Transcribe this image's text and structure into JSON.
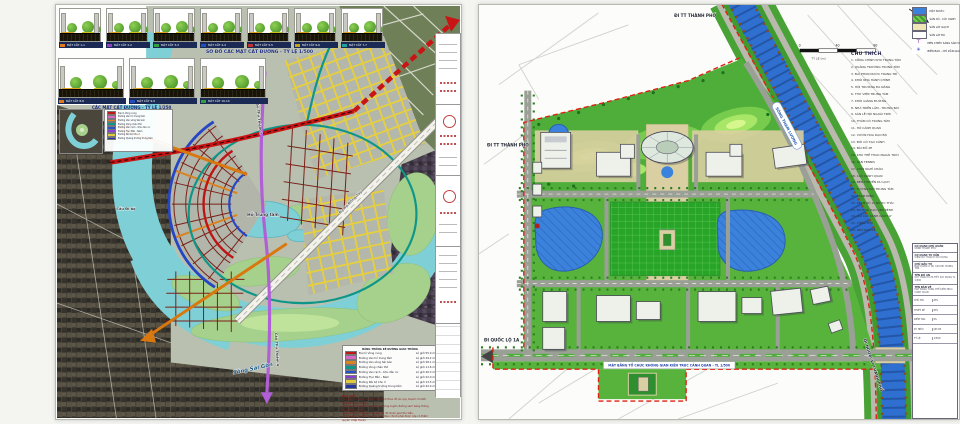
{
  "left_sheet": {
    "titles": {
      "row1_title": "SƠ ĐỒ CÁC MẶT CẮT ĐƯỜNG - TỶ LỆ 1/500",
      "row2_title": "CÁC MẶT CẮT ĐƯỜNG - TỶ LỆ 1/250"
    },
    "cross_sections_row1": [
      {
        "caption": "MẶT CẮT 1-1",
        "chip": "#e07820"
      },
      {
        "caption": "MẶT CẮT 2-2",
        "chip": "#9040c0"
      },
      {
        "caption": "MẶT CẮT 3-3",
        "chip": "#30a040"
      },
      {
        "caption": "MẶT CẮT 4-4",
        "chip": "#2050c0"
      },
      {
        "caption": "MẶT CẮT 5-5",
        "chip": "#c03030"
      },
      {
        "caption": "MẶT CẮT 6-6",
        "chip": "#c0a020"
      },
      {
        "caption": "MẶT CẮT 7-7",
        "chip": "#20a0a0"
      }
    ],
    "cross_sections_row2": [
      {
        "caption": "MẶT CẮT 8-8",
        "chip": "#e07820"
      },
      {
        "caption": "MẶT CẮT 9-9",
        "chip": "#2050c0"
      },
      {
        "caption": "MẶT CẮT 10-10",
        "chip": "#30a040"
      }
    ],
    "map_labels": {
      "river": "Sông Sài Gòn",
      "lake": "Hồ Trung tâm",
      "bridge_2": "Cầu Thủ Thiêm 2",
      "bridge_4": "Cầu Thủ Thiêm 4",
      "ped_bridge": "Cầu Đi bộ",
      "avenue": "Đại lộ Đông Tây"
    },
    "legend": {
      "header": "BẢNG THỐNG KÊ ĐƯỜNG GIAO THÔNG",
      "rows": [
        {
          "color": "#c01818",
          "label": "Đại lộ Vòng cung",
          "value": "Lộ giới 55.0 m"
        },
        {
          "color": "#d967c8",
          "label": "Đường Ven hồ trung tâm",
          "value": "Lộ giới 29.2 m"
        },
        {
          "color": "#d98422",
          "label": "Đường Ven sông Sài Gòn",
          "value": "Lộ giới 28.1 m"
        },
        {
          "color": "#0e9688",
          "label": "Đường Vùng châu thổ",
          "value": "Lộ giới 11.6 m"
        },
        {
          "color": "#2a52c8",
          "label": "Đường Ven rạch - Khu dân cư",
          "value": "Lộ giới 26.3 m"
        },
        {
          "color": "#8a3fd0",
          "label": "Đường Trục Bắc - Nam",
          "value": "Lộ giới 22.0 m"
        },
        {
          "color": "#e3c93e",
          "label": "Đường Nội bộ khu ở",
          "value": "Lộ giới 13.3 m"
        },
        {
          "color": "#27379e",
          "label": "Đường Quảng trường trung tâm",
          "value": "Lộ giới 42.0 m"
        }
      ]
    },
    "note": {
      "heading": "Ghi chú:",
      "lines": [
        "- Lộ giới các tuyến đường xác định theo đồ án quy hoạch chi tiết 1/2000 được duyệt.",
        "- Thông số kỹ thuật chi tiết của từng tuyến đường xem bảng thống kê mặt cắt đường.",
        "- Cao độ thiết kế lấy theo hệ cao độ Quốc gia Hòn Dấu.",
        "- Trong quá trình triển khai, mọi điều chỉnh phải được cấp có thẩm quyền chấp thuận."
      ]
    }
  },
  "right_sheet": {
    "scale_bar": {
      "ticks": [
        "0",
        "40",
        "80"
      ],
      "label": "TỶ LỆ (m)"
    },
    "legend": {
      "items": [
        {
          "icon": "water-swatch",
          "label": "MẶT NƯỚC"
        },
        {
          "icon": "green-swatch",
          "label": "SÂN CỎ - CÂY XANH"
        },
        {
          "icon": "brick-swatch",
          "label": "SÂN LÁT GẠCH"
        },
        {
          "icon": "stone-swatch",
          "label": "SÂN LÁT ĐÁ"
        },
        {
          "icon": "lamp-icon",
          "label": "ĐÈN CHIẾU SÁNG SÂN VƯỜN"
        },
        {
          "icon": "sign-icon",
          "label": "BIỂN BÁO - CHỈ DẪN GIAO THÔNG"
        }
      ]
    },
    "notes": {
      "heading": "CHÚ THÍCH",
      "items": [
        "1. CỔNG CHÍNH KHU TRUNG TÂM",
        "2. QUẢNG TRƯỜNG TRUNG TÂM",
        "3. ĐÀI PHUN NƯỚC TRANG TRÍ",
        "4. KHỐI NHÀ HÀNH CHÍNH",
        "5. HỘI TRƯỜNG ĐA NĂNG",
        "6. THƯ VIỆN TRUNG TÂM",
        "7. KHỐI GIẢNG ĐƯỜNG",
        "8. NHÀ TRIỂN LÃM - TRƯNG BÀY",
        "9. SÂN LỄ HỘI NGOÀI TRỜI",
        "10. THẢM CỎ TRUNG TÂM",
        "11. HỒ CẢNH QUAN",
        "12. VƯỜN HOA DẠO BỘ",
        "13. ĐỒI CỎ TẠO CẢNH",
        "14. BÃI ĐỖ XE",
        "15. KHU THỂ THAO NGOÀI TRỜI",
        "16. SÂN TENNIS",
        "17. CHÒI NGHỈ CHÂN",
        "18. CẦU CẢNH QUAN",
        "19. BẾN THUYỀN DU LỊCH",
        "20. TƯỢNG ĐÀI TRUNG TÂM",
        "21. TRẠM ĐIỆN",
        "22. TRẠM XỬ LÝ NƯỚC THẢI",
        "23. ĐƯỜNG DẠO VEN KÊNH",
        "24. DẢI CÂY XANH CÁCH LY",
        "25. CỔNG PHỤ",
        "26. NHÀ BẢO VỆ"
      ]
    },
    "labels": {
      "to_city_top": "ĐI TT THÀNH PHỐ",
      "to_city_left": "ĐI TT THÀNH PHỐ",
      "to_highway": "ĐI QUỐC LỘ 1A",
      "to_periphery": "ĐI NGOẠI VI THÀNH PHỐ",
      "canal": "SÔNG THAM LƯƠNG",
      "caption": "MẶT BẰNG TỔ CHỨC KHÔNG GIAN KIẾN TRÚC CẢNH QUAN - TL 1/500"
    },
    "title_block": {
      "sections": [
        {
          "heading": "CƠ QUAN CHỦ QUẢN",
          "line": "UBND THÀNH PHỐ"
        },
        {
          "heading": "CƠ QUAN TƯ VẤN",
          "line": "VIỆN QUY HOẠCH XÂY DỰNG"
        },
        {
          "heading": "CHỦ ĐẦU TƯ",
          "line": "BAN QUẢN LÝ DỰ ÁN KHU TRUNG TÂM"
        },
        {
          "heading": "TÊN ĐỒ ÁN",
          "line": "QUY HOẠCH CHI TIẾT XÂY DỰNG TL 1/500"
        },
        {
          "heading": "TÊN BẢN VẼ",
          "line": "MẶT BẰNG TỔNG THỂ KIẾN TRÚC CẢNH QUAN"
        }
      ],
      "table": [
        [
          "CHỦ TRÌ",
          "KTS"
        ],
        [
          "THIẾT KẾ",
          "KTS"
        ],
        [
          "KIỂM TRA",
          "KS"
        ],
        [
          "KÝ HIỆU",
          "QH-05"
        ],
        [
          "TỶ LỆ",
          "1/500"
        ]
      ]
    }
  }
}
